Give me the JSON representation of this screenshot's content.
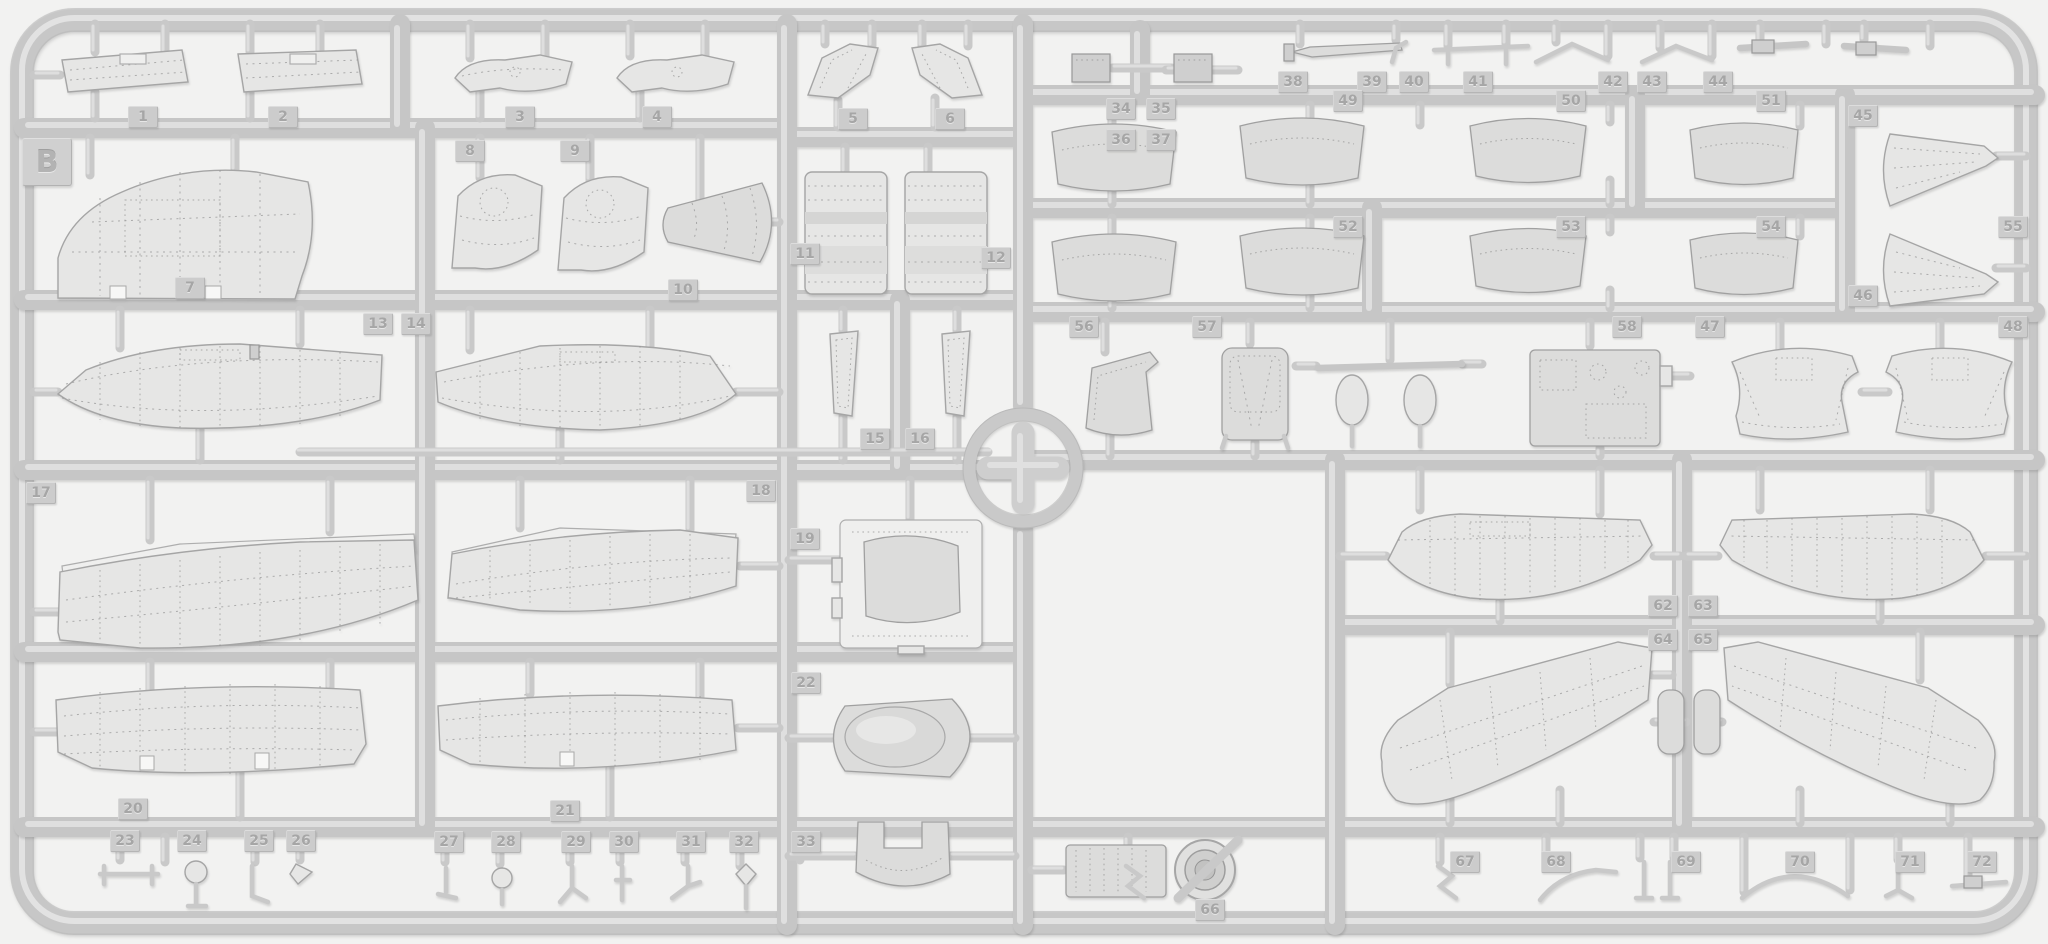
{
  "sprue": {
    "letter": "B",
    "material_look": "light gray injection-molded styrene",
    "locator_icon": "cross-in-circle-locator"
  },
  "colors": {
    "background": "#f2f2f1",
    "runner": "#c6c6c6",
    "runner_highlight": "#e1e1e1",
    "part_surface": "#e6e6e5",
    "part_dark": "#cfcfcf",
    "tag_face": "#cccccc",
    "tag_text": "#a6a6a6",
    "rivet_line": "#979797"
  },
  "part_tags": [
    {
      "n": "1",
      "x": 128,
      "y": 106
    },
    {
      "n": "2",
      "x": 268,
      "y": 106
    },
    {
      "n": "3",
      "x": 505,
      "y": 106
    },
    {
      "n": "4",
      "x": 642,
      "y": 106
    },
    {
      "n": "5",
      "x": 838,
      "y": 108
    },
    {
      "n": "6",
      "x": 935,
      "y": 108
    },
    {
      "n": "7",
      "x": 175,
      "y": 277
    },
    {
      "n": "8",
      "x": 455,
      "y": 140
    },
    {
      "n": "9",
      "x": 560,
      "y": 140
    },
    {
      "n": "10",
      "x": 668,
      "y": 279
    },
    {
      "n": "11",
      "x": 790,
      "y": 243
    },
    {
      "n": "12",
      "x": 981,
      "y": 247
    },
    {
      "n": "13",
      "x": 363,
      "y": 313
    },
    {
      "n": "14",
      "x": 401,
      "y": 313
    },
    {
      "n": "15",
      "x": 860,
      "y": 428
    },
    {
      "n": "16",
      "x": 905,
      "y": 428
    },
    {
      "n": "17",
      "x": 26,
      "y": 482
    },
    {
      "n": "18",
      "x": 746,
      "y": 480
    },
    {
      "n": "19",
      "x": 790,
      "y": 528
    },
    {
      "n": "20",
      "x": 118,
      "y": 798
    },
    {
      "n": "21",
      "x": 550,
      "y": 800
    },
    {
      "n": "22",
      "x": 791,
      "y": 672
    },
    {
      "n": "23",
      "x": 110,
      "y": 830
    },
    {
      "n": "24",
      "x": 177,
      "y": 830
    },
    {
      "n": "25",
      "x": 244,
      "y": 830
    },
    {
      "n": "26",
      "x": 286,
      "y": 830
    },
    {
      "n": "27",
      "x": 434,
      "y": 831
    },
    {
      "n": "28",
      "x": 491,
      "y": 831
    },
    {
      "n": "29",
      "x": 561,
      "y": 831
    },
    {
      "n": "30",
      "x": 609,
      "y": 831
    },
    {
      "n": "31",
      "x": 676,
      "y": 831
    },
    {
      "n": "32",
      "x": 729,
      "y": 831
    },
    {
      "n": "33",
      "x": 791,
      "y": 831
    },
    {
      "n": "34",
      "x": 1106,
      "y": 98
    },
    {
      "n": "35",
      "x": 1146,
      "y": 98
    },
    {
      "n": "36",
      "x": 1106,
      "y": 129
    },
    {
      "n": "37",
      "x": 1146,
      "y": 129
    },
    {
      "n": "38",
      "x": 1278,
      "y": 71
    },
    {
      "n": "39",
      "x": 1357,
      "y": 71
    },
    {
      "n": "40",
      "x": 1399,
      "y": 71
    },
    {
      "n": "41",
      "x": 1463,
      "y": 71
    },
    {
      "n": "42",
      "x": 1598,
      "y": 71
    },
    {
      "n": "43",
      "x": 1637,
      "y": 71
    },
    {
      "n": "44",
      "x": 1703,
      "y": 71
    },
    {
      "n": "45",
      "x": 1848,
      "y": 105
    },
    {
      "n": "46",
      "x": 1848,
      "y": 285
    },
    {
      "n": "49",
      "x": 1333,
      "y": 90
    },
    {
      "n": "50",
      "x": 1556,
      "y": 90
    },
    {
      "n": "51",
      "x": 1756,
      "y": 90
    },
    {
      "n": "52",
      "x": 1333,
      "y": 216
    },
    {
      "n": "53",
      "x": 1556,
      "y": 216
    },
    {
      "n": "54",
      "x": 1756,
      "y": 216
    },
    {
      "n": "55",
      "x": 1998,
      "y": 216
    },
    {
      "n": "56",
      "x": 1069,
      "y": 316
    },
    {
      "n": "57",
      "x": 1192,
      "y": 316
    },
    {
      "n": "58",
      "x": 1612,
      "y": 316
    },
    {
      "n": "47",
      "x": 1695,
      "y": 316
    },
    {
      "n": "48",
      "x": 1998,
      "y": 316
    },
    {
      "n": "62",
      "x": 1648,
      "y": 595
    },
    {
      "n": "63",
      "x": 1688,
      "y": 595
    },
    {
      "n": "64",
      "x": 1648,
      "y": 629
    },
    {
      "n": "65",
      "x": 1688,
      "y": 629
    },
    {
      "n": "66",
      "x": 1195,
      "y": 899
    },
    {
      "n": "67",
      "x": 1450,
      "y": 851
    },
    {
      "n": "68",
      "x": 1541,
      "y": 851
    },
    {
      "n": "69",
      "x": 1671,
      "y": 851
    },
    {
      "n": "70",
      "x": 1785,
      "y": 851
    },
    {
      "n": "71",
      "x": 1895,
      "y": 851
    },
    {
      "n": "72",
      "x": 1967,
      "y": 851
    }
  ]
}
